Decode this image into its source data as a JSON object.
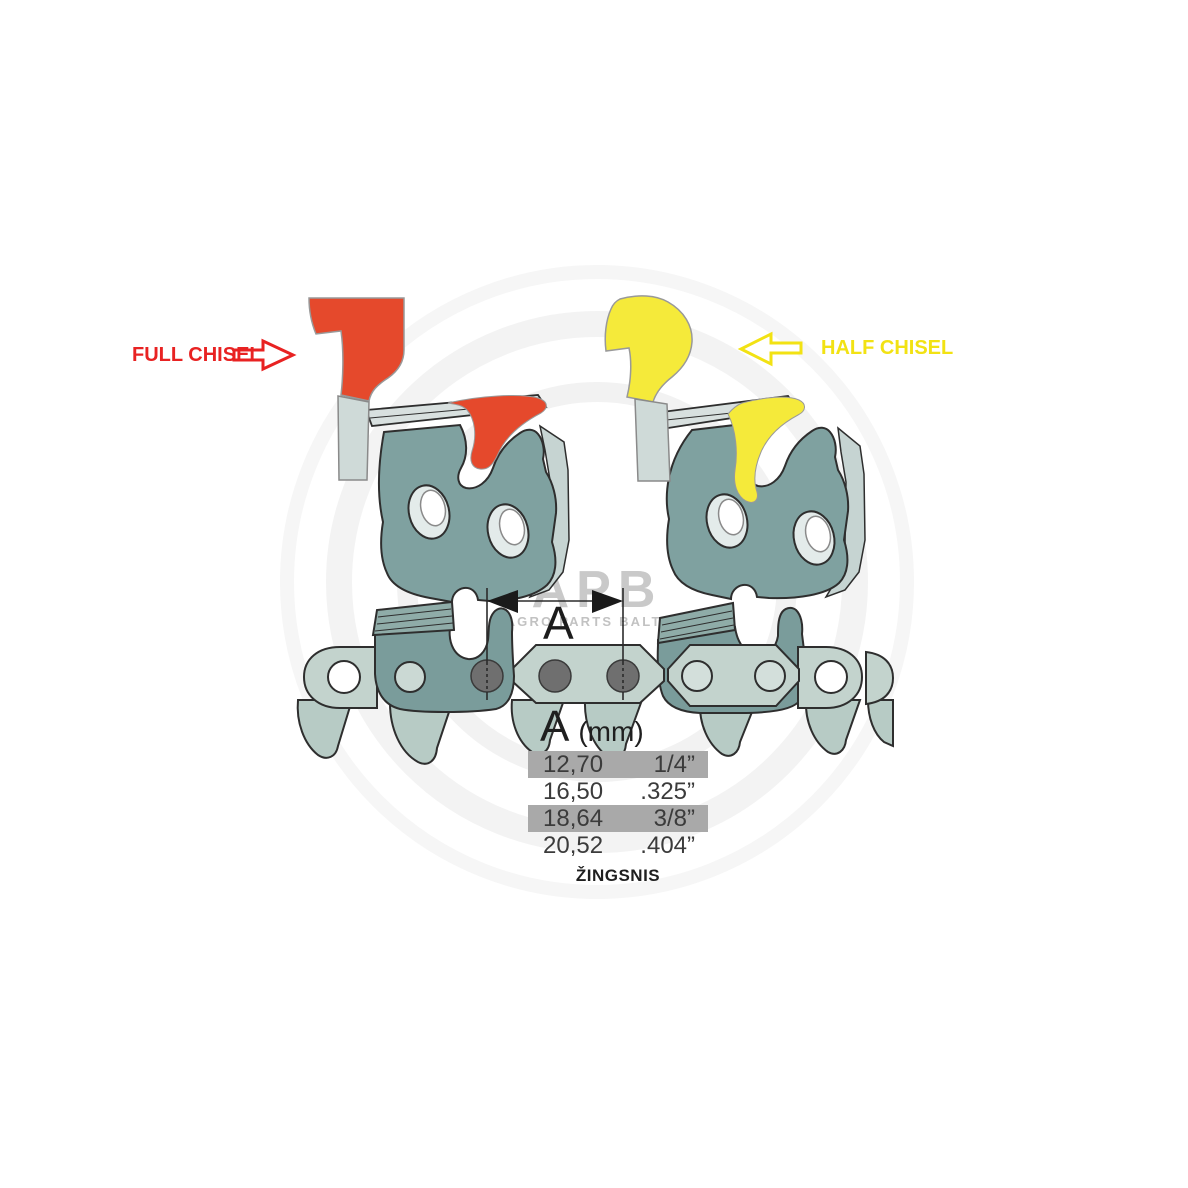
{
  "diagram": {
    "full_chisel_label": "FULL CHISEL",
    "half_chisel_label": "HALF CHISEL",
    "dimension_label": "A"
  },
  "pitch_table": {
    "header_letter": "A",
    "header_unit": "(mm)",
    "rows": [
      {
        "mm": "12,70",
        "inch": "1/4”"
      },
      {
        "mm": "16,50",
        "inch": ".325”"
      },
      {
        "mm": "18,64",
        "inch": "3/8”"
      },
      {
        "mm": "20,52",
        "inch": ".404”"
      }
    ],
    "caption": "ŽINGSNIS"
  },
  "watermark": {
    "logo": "APB",
    "subtitle": "AGRO PARTS BALTIJA"
  },
  "colors": {
    "full_chisel_red": "#e5492c",
    "half_chisel_yellow": "#f5ea3a",
    "label_red": "#e82222",
    "label_yellow": "#f2e213",
    "steel_teal": "#7fa1a0",
    "row_highlight_gray": "#a9a9a9"
  }
}
